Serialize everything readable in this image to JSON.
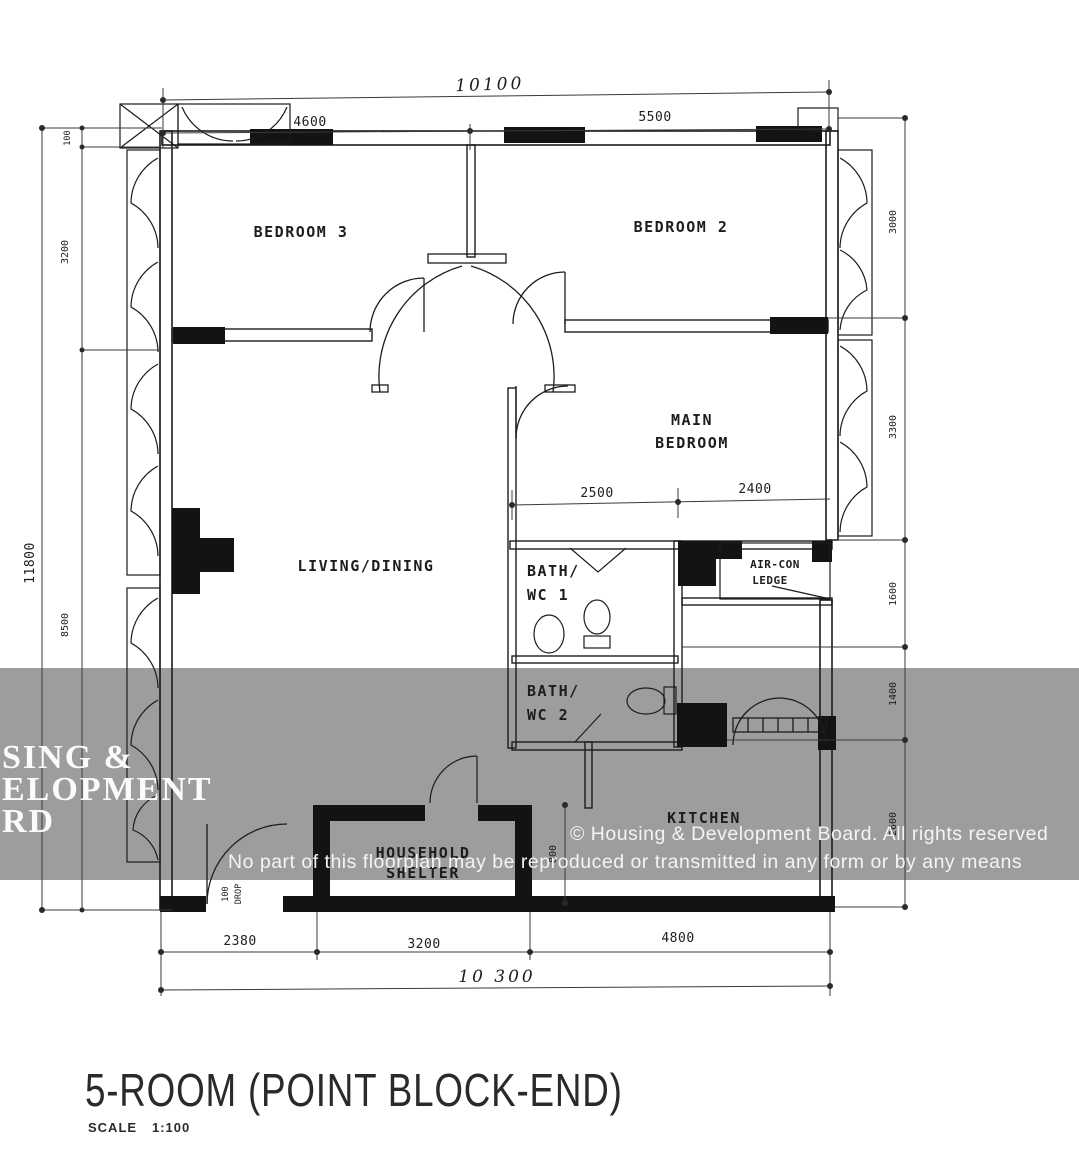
{
  "title": {
    "text": "5-ROOM (POINT BLOCK-END)",
    "scale_label": "SCALE",
    "scale_value": "1:100"
  },
  "rooms": {
    "bedroom3": "BEDROOM 3",
    "bedroom2": "BEDROOM 2",
    "main_bedroom_line1": "MAIN",
    "main_bedroom_line2": "BEDROOM",
    "living_dining": "LIVING/DINING",
    "bath1_line1": "BATH/",
    "bath1_line2": "WC 1",
    "bath2_line1": "BATH/",
    "bath2_line2": "WC 2",
    "kitchen": "KITCHEN",
    "shelter_line1": "HOUSEHOLD",
    "shelter_line2": "SHELTER",
    "aircon_line1": "AIR-CON",
    "aircon_line2": "LEDGE"
  },
  "dims": {
    "top_overall": "10100",
    "top_left": "4600",
    "top_right": "5500",
    "left_overall": "11800",
    "left_seg1": "100",
    "left_seg2": "3200",
    "left_seg3": "8500",
    "right_seg1": "3000",
    "right_seg2": "3300",
    "right_seg3": "1600",
    "right_seg4": "1400",
    "right_seg5": "2600",
    "bottom_seg1": "2380",
    "bottom_seg2": "3200",
    "bottom_seg3": "4800",
    "bottom_overall": "10 300",
    "main_bed_left": "2500",
    "main_bed_right": "2400",
    "shelter_side": "800",
    "entrance_line1": "100",
    "entrance_line2": "DROP"
  },
  "watermark": {
    "big_line1": "SING &",
    "big_line2": "ELOPMENT",
    "big_line3": "RD",
    "copyright": "© Housing & Development Board. All rights reserved",
    "notice": "No part of this floorplan may be reproduced or transmitted in any form or by any means"
  },
  "colors": {
    "ink": "#1c1c1c",
    "paper": "#ffffff",
    "band": "#9d9d9d"
  }
}
